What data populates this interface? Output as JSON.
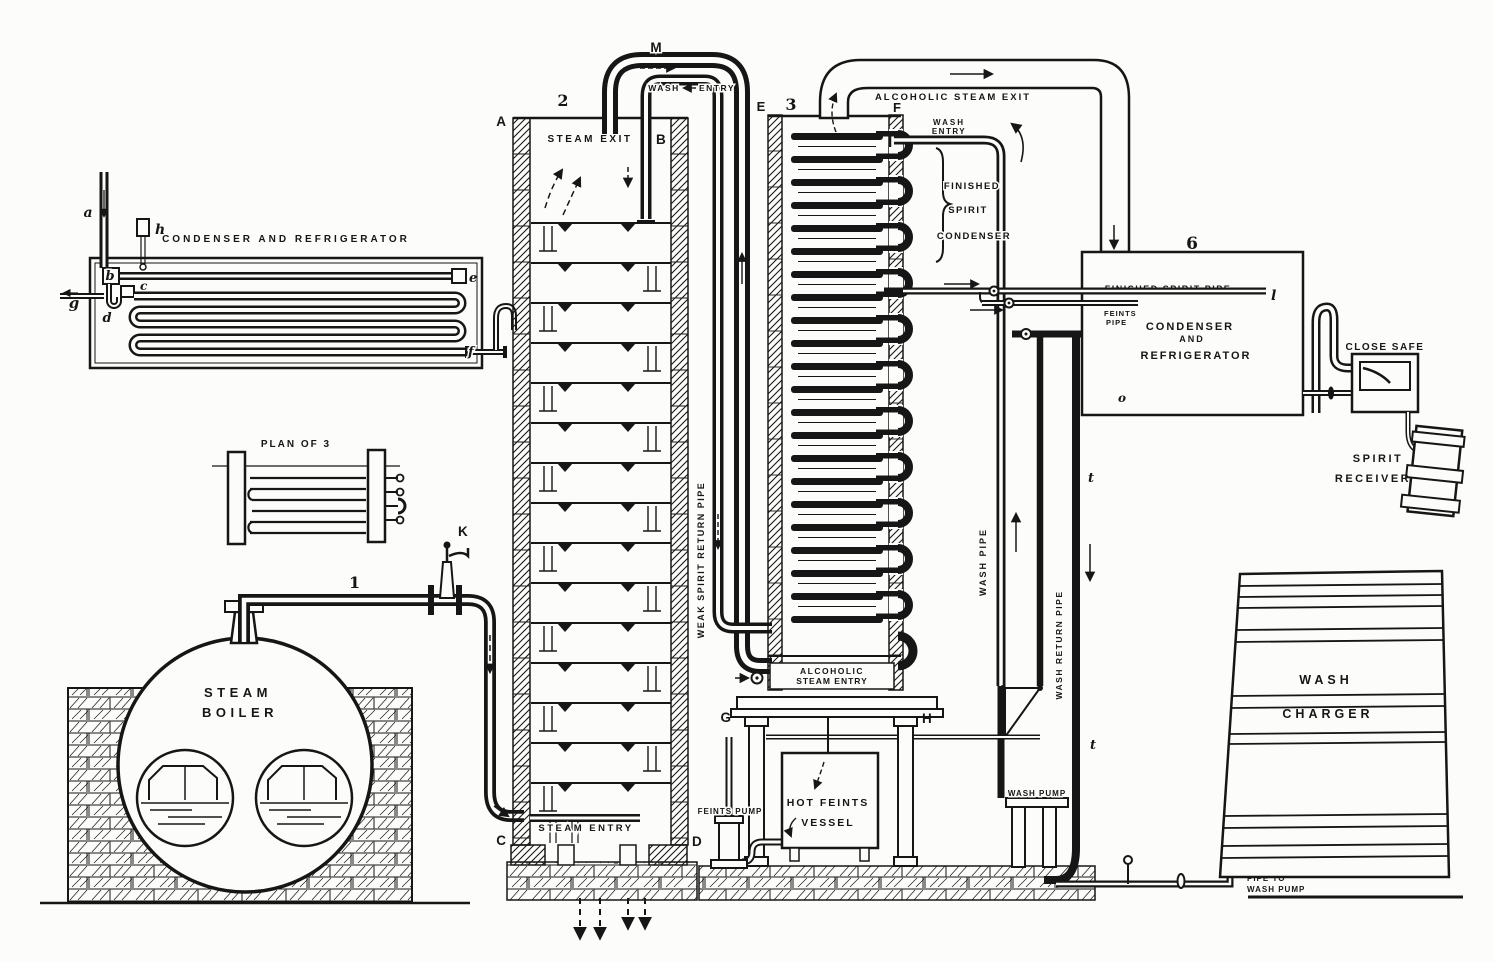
{
  "labels": {
    "left_condenser": {
      "title": "CONDENSER  AND  REFRIGERATOR",
      "a": "a",
      "h": "h",
      "b": "b",
      "c": "c",
      "d": "d",
      "e": "e",
      "f": "f",
      "g": "g"
    },
    "plan": {
      "title": "PLAN OF 3"
    },
    "boiler": {
      "line1": "STEAM",
      "line2": "BOILER"
    },
    "steam_main": {
      "num": "1",
      "valve": "K",
      "exit": "STEAM EXIT",
      "entry": "STEAM ENTRY"
    },
    "analyzer": {
      "num": "2",
      "A": "A",
      "B": "B",
      "C": "C",
      "D": "D",
      "M": "M",
      "wash": "WASH",
      "entry": "ENTRY"
    },
    "rectifier": {
      "num": "3",
      "E": "E",
      "F": "F",
      "G": "G",
      "H": "H",
      "alc_exit": "ALCOHOLIC  STEAM  EXIT",
      "wash": "WASH",
      "entry": "ENTRY",
      "fsc1": "FINISHED",
      "fsc2": "SPIRIT",
      "fsc3": "CONDENSER",
      "alc_entry1": "ALCOHOLIC",
      "alc_entry2": "STEAM ENTRY"
    },
    "pipes": {
      "weak_spirit": "WEAK SPIRIT RETURN PIPE",
      "wash_pipe": "WASH   PIPE",
      "wash_return": "WASH RETURN PIPE",
      "to_pump1": "PIPE TO",
      "to_pump2": "WASH PUMP",
      "t_upper": "t",
      "t_lower": "t"
    },
    "condenser6": {
      "num": "6",
      "spirit_pipe": "FINISHED  SPIRIT  PIPE",
      "l": "l",
      "feints1": "FEINTS",
      "feints2": "PIPE",
      "t1": "CONDENSER",
      "t2": "AND",
      "t3": "REFRIGERATOR",
      "o": "o"
    },
    "safe": {
      "label": "CLOSE SAFE"
    },
    "receiver": {
      "l1": "SPIRIT",
      "l2": "RECEIVER"
    },
    "charger": {
      "l1": "WASH",
      "l2": "CHARGER"
    },
    "vessel": {
      "l1": "HOT FEINTS",
      "l2": "VESSEL"
    },
    "pumps": {
      "feints": "FEINTS PUMP",
      "wash": "WASH PUMP"
    }
  },
  "structure": {
    "analyzer_trays": 15,
    "rectifier_tubes": 22,
    "rectifier_ubends": 11,
    "charger_bands": [
      586,
      597,
      608,
      630,
      642,
      696,
      708,
      734,
      744,
      816,
      828,
      846,
      858
    ],
    "wall_pitch": 36,
    "drain_xs": [
      580,
      600,
      628,
      645
    ]
  }
}
